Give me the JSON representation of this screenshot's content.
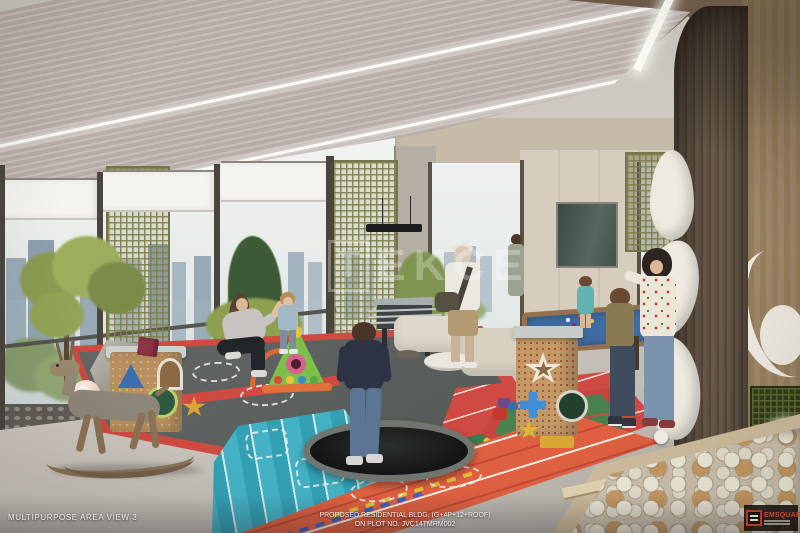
{
  "captions": {
    "view_label": "MULTIPURPOSE AREA VIEW 3",
    "project_line1": "PROPOSED RESIDENTIAL BLDG. (G+4P+12+ROOF)",
    "project_line2": "ON PLOT NO. JVC14TMRM002"
  },
  "watermark": {
    "boxed_letter": "T",
    "text": "EKCE"
  },
  "logo": {
    "name": "EMSQUARE"
  },
  "palette": {
    "ceiling_slat": "#b7ada8",
    "ceiling_wood": "#5d4a3a",
    "column_wood": "#56483a",
    "lattice_green": "#80804c",
    "floor_gray": "#c7c2ba",
    "mat_dark": "#5a5f5d",
    "mat_red": "#cf4a40",
    "mat_teal": "#44b2c4",
    "mat_green": "#3c7a50",
    "track_orange": "#de6040",
    "slide_white": "#eeeae0",
    "ball_tan": "#c79a63",
    "sofa_cream": "#ded8ca",
    "pool_felt_blue": "#3e6ba0"
  }
}
